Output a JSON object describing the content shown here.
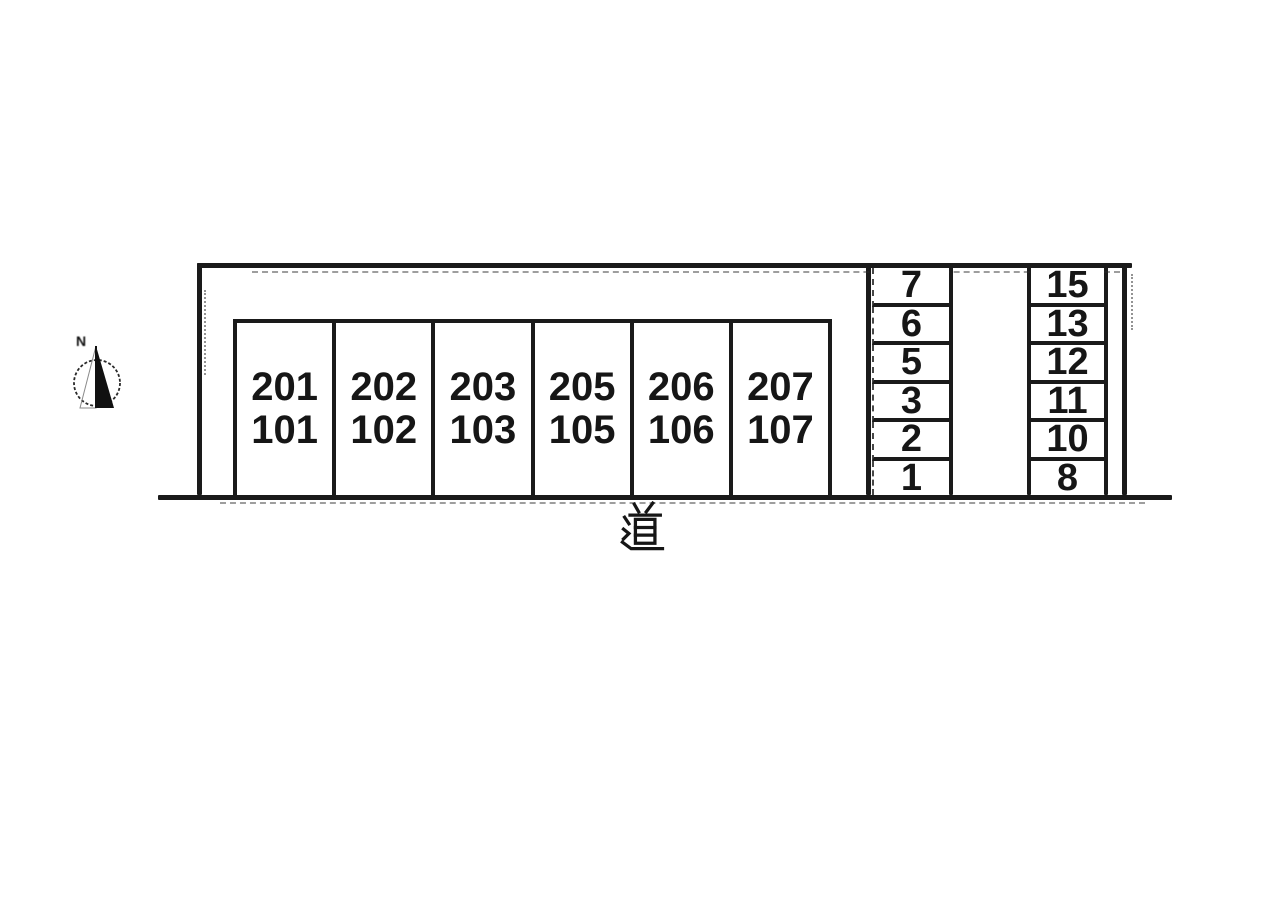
{
  "plan": {
    "road_label": "道",
    "compass_label": "N",
    "rooms": [
      {
        "upper": "201",
        "lower": "101"
      },
      {
        "upper": "202",
        "lower": "102"
      },
      {
        "upper": "203",
        "lower": "103"
      },
      {
        "upper": "205",
        "lower": "105"
      },
      {
        "upper": "206",
        "lower": "106"
      },
      {
        "upper": "207",
        "lower": "107"
      }
    ],
    "parking": {
      "left_column": [
        "7",
        "6",
        "5",
        "3",
        "2",
        "1"
      ],
      "right_column": [
        "15",
        "13",
        "12",
        "11",
        "10",
        "8"
      ]
    },
    "colors": {
      "line": "#1a1a1a",
      "background": "#ffffff"
    }
  }
}
